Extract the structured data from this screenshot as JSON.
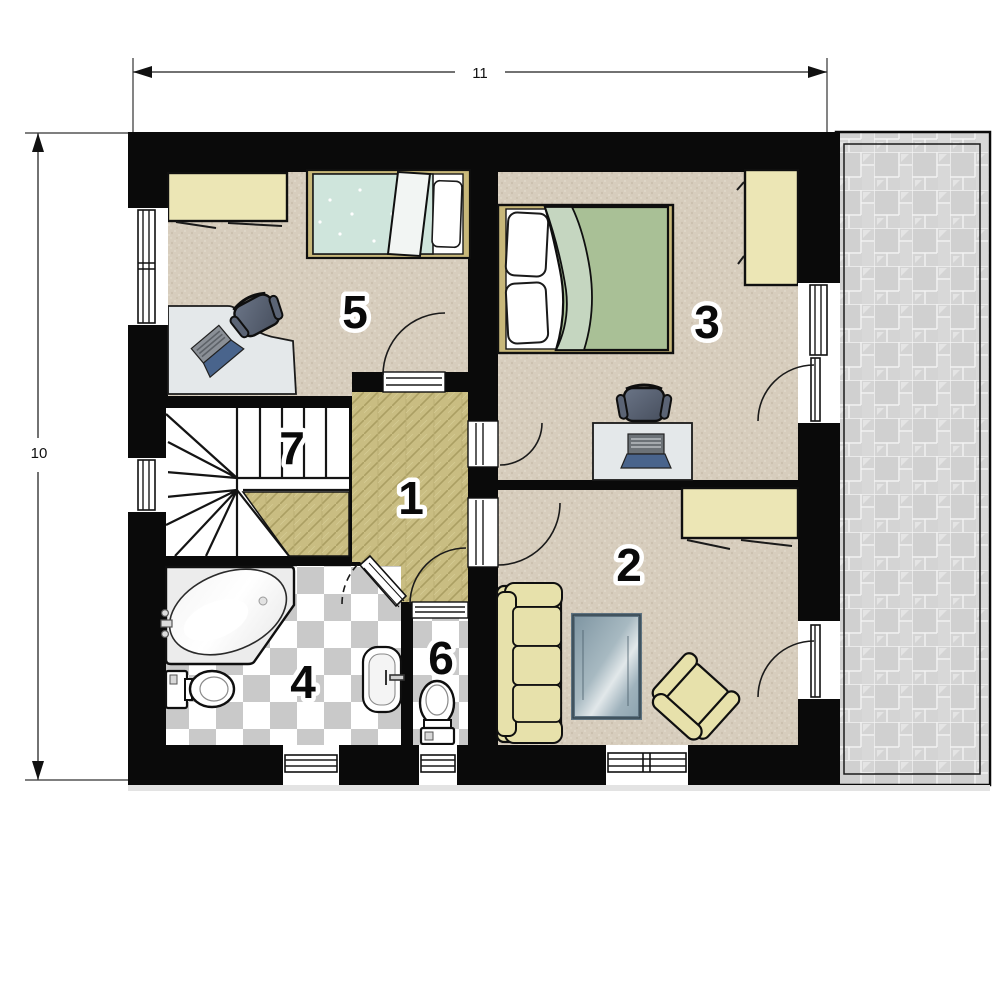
{
  "dimensions": {
    "width_label": "11",
    "height_label": "10"
  },
  "rooms": [
    {
      "number": "1",
      "name": "hallway"
    },
    {
      "number": "2",
      "name": "living-room"
    },
    {
      "number": "3",
      "name": "bedroom-large"
    },
    {
      "number": "4",
      "name": "bathroom"
    },
    {
      "number": "5",
      "name": "bedroom-small"
    },
    {
      "number": "6",
      "name": "wc"
    },
    {
      "number": "7",
      "name": "staircase"
    }
  ],
  "colors": {
    "wall": "#0a0a0a",
    "carpet": "#d7cdbd",
    "wood_floor": "#c9bd82",
    "checker_gray": "#c9c9c9",
    "terrace_tile": "#d4d4d4",
    "sofa_yellow": "#e7e1ab",
    "wardrobe_yellow": "#ece6b5",
    "bed_frame_tan": "#c8b87a",
    "blanket_green": "#a9c096",
    "blanket_mint": "#cfe5dc",
    "glass_blue": "#93a7b2",
    "desk_gray": "#e4e8ea",
    "chair_dark": "#5b6475",
    "laptop_blue": "#49648c",
    "tub_white": "#ffffff"
  }
}
